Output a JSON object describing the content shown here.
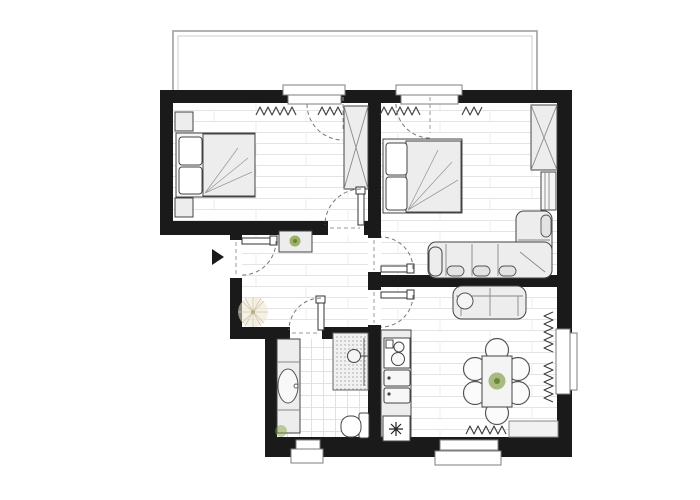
{
  "meta": {
    "type": "architectural-floor-plan",
    "description": "Top-down 2D floor plan of a two-bedroom apartment with balcony, hallway, bathroom and combined kitchen/dining room",
    "canvas": {
      "width": 700,
      "height": 500
    }
  },
  "colors": {
    "wall": "#1a1a1a",
    "floor": "#ffffff",
    "plank_line": "#e4e4e4",
    "tile_line": "#e2e2e2",
    "furniture_fill": "#ededed",
    "furniture_stroke": "#444444",
    "window_frame": "#7d7d7d",
    "door_arc": "#777777",
    "balcony_line": "#a0a0a0",
    "radiator": "#3c3c3c",
    "plant_green": "#7f9b3f",
    "dried_plant_tan": "#cfc7a6"
  },
  "rooms": [
    {
      "id": "balcony",
      "label": "Balcony",
      "furniture": []
    },
    {
      "id": "bedroom-left",
      "label": "Bedroom (top left)",
      "furniture": [
        "double-bed",
        "pillow",
        "pillow",
        "nightstand",
        "nightstand",
        "wardrobe-x",
        "radiator",
        "balcony-door"
      ]
    },
    {
      "id": "living-bedroom-right",
      "label": "Living / bedroom (top right)",
      "furniture": [
        "double-bed",
        "pillow",
        "pillow",
        "wardrobe-x",
        "shelf",
        "corner-sofa",
        "radiator",
        "balcony-door"
      ]
    },
    {
      "id": "hallway",
      "label": "Hallway (center)",
      "furniture": [
        "sideboard-with-plant",
        "dried-plant",
        "entrance-door",
        "entrance-marker"
      ]
    },
    {
      "id": "bathroom",
      "label": "Bathroom (bottom center)",
      "furniture": [
        "washbasin-counter",
        "oval-basin",
        "shower",
        "shower-head",
        "toilet",
        "small-plant",
        "window"
      ]
    },
    {
      "id": "kitchen-dining",
      "label": "Kitchen / dining (bottom right)",
      "furniture": [
        "kitchen-counter",
        "stove-two-burners",
        "double-sink",
        "freezer-star",
        "loveseat",
        "dining-table-with-plant",
        "chair",
        "chair",
        "chair",
        "chair",
        "chair",
        "chair",
        "sideboard",
        "radiator",
        "radiator",
        "radiator",
        "window",
        "window"
      ]
    }
  ],
  "symbols": {
    "entrance_marker": "solid black triangle pointing at entrance door",
    "door_swing": "dashed quarter-circle arc with door leaf",
    "radiator": "zigzag line under window",
    "wardrobe_x": "rectangle with crossed diagonals",
    "freezer_star": "eight-point asterisk in square",
    "shower": "dotted square with shower head circle"
  }
}
